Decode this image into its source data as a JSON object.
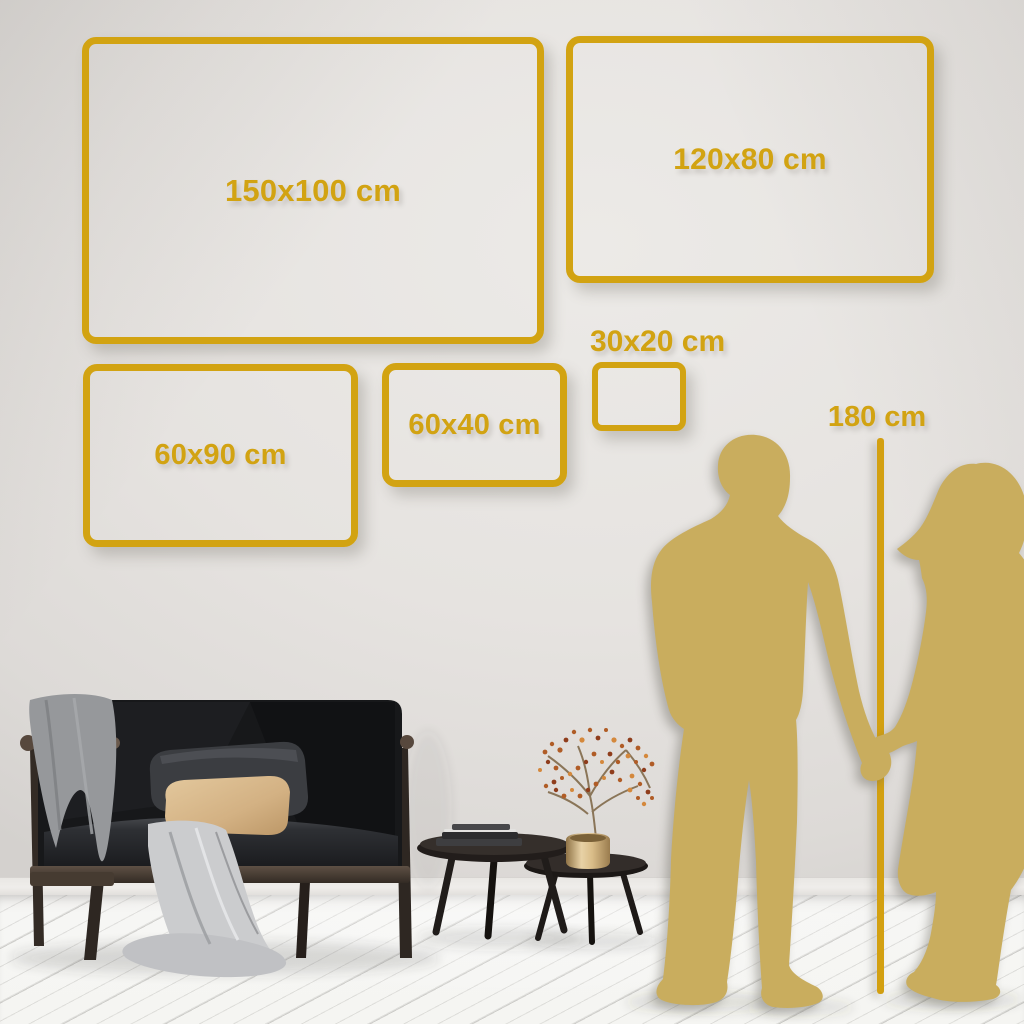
{
  "size_guide": {
    "title_note": "wall art size comparison",
    "frames": [
      {
        "id": "150x100",
        "label": "150x100 cm"
      },
      {
        "id": "120x80",
        "label": "120x80 cm"
      },
      {
        "id": "60x90",
        "label": "60x90 cm"
      },
      {
        "id": "60x40",
        "label": "60x40 cm"
      },
      {
        "id": "30x20",
        "label": "30x20 cm"
      }
    ],
    "height_marker": {
      "label": "180 cm"
    }
  },
  "scene": {
    "people": "couple-silhouette-holding-hands",
    "furniture": [
      "sofa-with-wood-frame",
      "gray-blanket",
      "white-throw",
      "dark-pillow",
      "beige-pillow",
      "coffee-table-large",
      "coffee-table-small",
      "books",
      "brass-vase",
      "berry-branch"
    ]
  },
  "colors": {
    "gold": "#D2A312",
    "gold-line": "#D3A011",
    "silhouette": "#C9AD5E",
    "wall": "#E6E3E0",
    "floor": "#F5F5F2"
  }
}
